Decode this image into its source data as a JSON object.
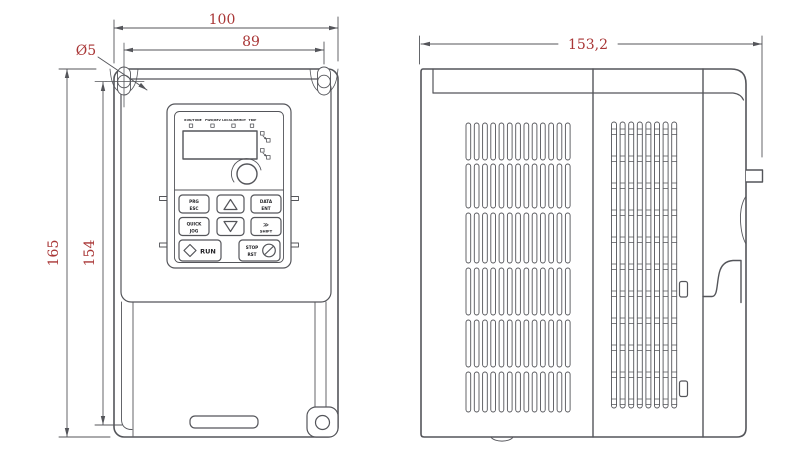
{
  "drawing": {
    "subject": "frequency-inverter-dimension-drawing",
    "colors": {
      "line": "#54555a",
      "dimension_text": "#a93636",
      "background": "#ffffff"
    },
    "dimensions": {
      "width_total": "100",
      "hole_span_horizontal": "89",
      "hole_diameter": "Ø5",
      "height_total": "165",
      "hole_span_vertical": "154",
      "depth_total": "153,2"
    },
    "keypad": {
      "led_labels": [
        "RUN/TUNE",
        "FWD/REV",
        "LOCAL/REMOT",
        "TRIP"
      ],
      "buttons": {
        "prg": {
          "line1": "PRG",
          "line2": "ESC"
        },
        "up": {
          "icon": "up-arrow"
        },
        "data": {
          "line1": "DATA",
          "line2": "ENT"
        },
        "quick": {
          "line1": "QUICK",
          "line2": "JOG"
        },
        "down": {
          "icon": "down-arrow"
        },
        "shift": {
          "arrow": "≫",
          "label": "SHIFT"
        },
        "run": {
          "icon": "diamond",
          "label": "RUN"
        },
        "stop": {
          "line1": "STOP",
          "line2": "RST",
          "icon": "circle-slash"
        }
      }
    }
  }
}
